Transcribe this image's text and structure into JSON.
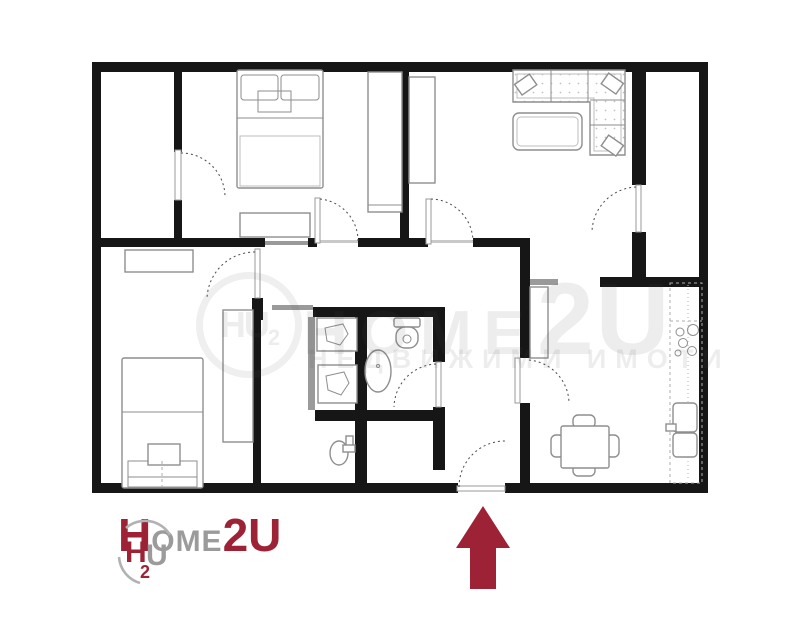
{
  "canvas": {
    "width": 800,
    "height": 640,
    "background": "#ffffff"
  },
  "colors": {
    "wall": "#161616",
    "light_wall": "#9a9a9a",
    "furniture": "#8e8e8e",
    "furniture_light": "#bdbdbd",
    "door": "#4a4a4a",
    "brand_red": "#9e2236",
    "brand_gray": "#9b9b9b"
  },
  "logo": {
    "emblem": {
      "h": "H",
      "u": "U",
      "sub": "2"
    },
    "wordmark": {
      "h": "H",
      "ome": "OME",
      "two_u": "2U"
    }
  },
  "watermark": {
    "emblem_text": "HU",
    "emblem_sub": "2",
    "wordmark_h": "H",
    "wordmark_ome": "OME",
    "wordmark_2u": "2U",
    "tagline": "НЕДВИЖИМИ ИМОТИ"
  },
  "annotations": {
    "entrance_marker": "up-arrow"
  }
}
